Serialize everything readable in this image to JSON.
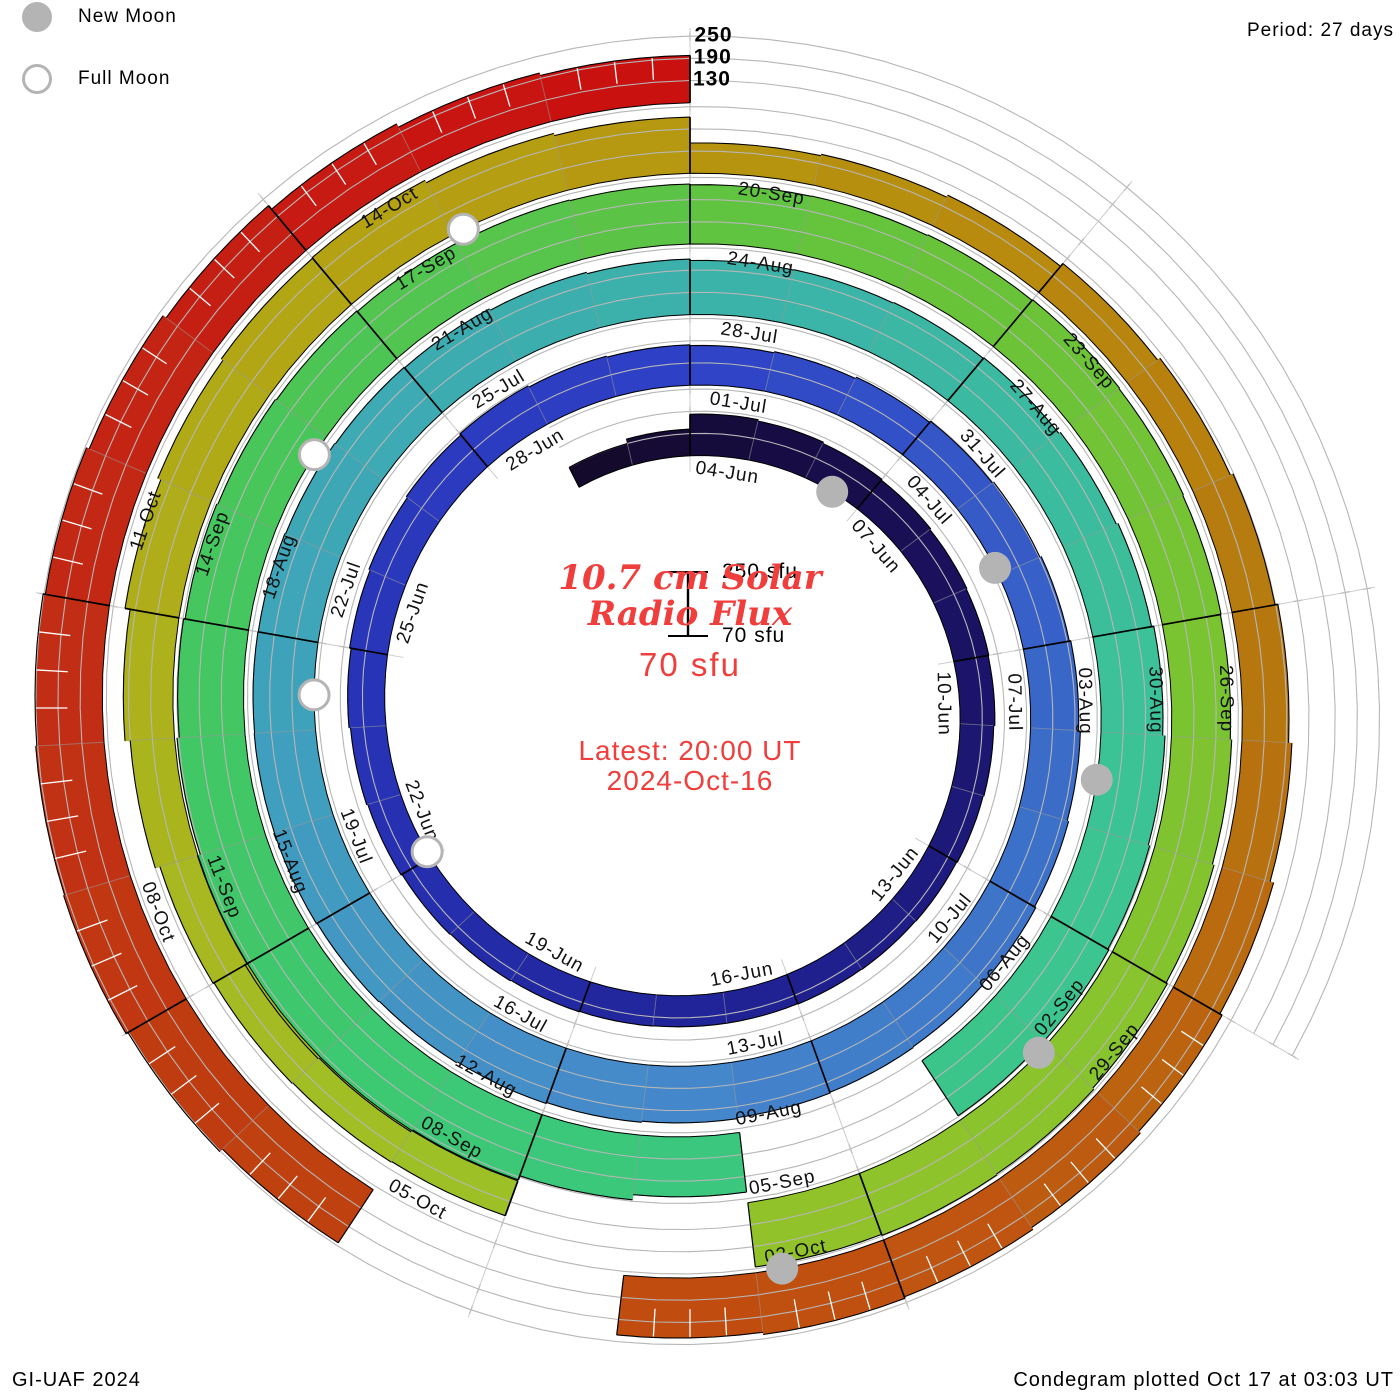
{
  "header": {
    "legend": {
      "new_moon": "New Moon",
      "full_moon": "Full Moon"
    },
    "period": "Period: 27 days"
  },
  "footer": {
    "left": "GI-UAF 2024",
    "right": "Condegram plotted Oct 17 at 03:03 UT"
  },
  "center": {
    "title_line1": "10.7 cm Solar",
    "title_line2": "Radio Flux",
    "base_flux": "70 sfu",
    "latest_line1": "Latest: 20:00 UT",
    "latest_line2": "2024-Oct-16",
    "scale_top_label": "250 sfu",
    "scale_bottom_label": "70 sfu"
  },
  "colors": {
    "accent_red": "#ef3e3c",
    "grid_gray": "#b6b6b6",
    "radial_gray": "#c4c4c4",
    "moon_gray": "#b4b4b4",
    "outline_black": "#000000",
    "label_black": "#111111"
  },
  "chart_data": {
    "type": "bar",
    "variant": "condegram-spiral",
    "title": "10.7 cm Solar Radio Flux",
    "start_date": "2024-06-02",
    "end_date": "2024-10-16",
    "period_days": 27,
    "flux_base_sfu": 70,
    "flux_scale_top_sfu": 250,
    "gridline_levels_sfu": [
      130,
      190,
      250
    ],
    "radial_scale_labels": [
      "250",
      "190",
      "130"
    ],
    "first_label_day_offset": 2,
    "label_step_days": 3,
    "date_labels": [
      "04-Jun",
      "07-Jun",
      "10-Jun",
      "13-Jun",
      "16-Jun",
      "19-Jun",
      "22-Jun",
      "25-Jun",
      "28-Jun",
      "01-Jul",
      "04-Jul",
      "07-Jul",
      "10-Jul",
      "13-Jul",
      "16-Jul",
      "19-Jul",
      "22-Jul",
      "25-Jul",
      "28-Jul",
      "31-Jul",
      "03-Aug",
      "06-Aug",
      "09-Aug",
      "12-Aug",
      "15-Aug",
      "18-Aug",
      "21-Aug",
      "24-Aug",
      "27-Aug",
      "30-Aug",
      "02-Sep",
      "05-Sep",
      "08-Sep",
      "11-Sep",
      "14-Sep",
      "17-Sep",
      "20-Sep",
      "23-Sep",
      "26-Sep",
      "29-Sep",
      "02-Oct",
      "05-Oct",
      "08-Oct",
      "11-Oct",
      "14-Oct"
    ],
    "flux": [
      130,
      142,
      182,
      178,
      174,
      171,
      168,
      166,
      164,
      161,
      159,
      157,
      156,
      155,
      154,
      154,
      155,
      156,
      158,
      160,
      163,
      166,
      170,
      174,
      178,
      182,
      186,
      182,
      179,
      177,
      180,
      184,
      188,
      192,
      196,
      200,
      205,
      209,
      213,
      216,
      218,
      220,
      223,
      226,
      229,
      232,
      234,
      236,
      236,
      235,
      234,
      232,
      230,
      228,
      224,
      220,
      216,
      217,
      219,
      221,
      226,
      231,
      237,
      243,
      247,
      250,
      248,
      null,
      null,
      232,
      246,
      258,
      265,
      268,
      262,
      254,
      248,
      244,
      241,
      238,
      236,
      234,
      232,
      230,
      231,
      233,
      235,
      233,
      231,
      229,
      233,
      238,
      242,
      246,
      248,
      245,
      null,
      null,
      170,
      172,
      174,
      177,
      190,
      204,
      218,
      227,
      233,
      235,
      228,
      222,
      152,
      156,
      162,
      172,
      180,
      188,
      196,
      205,
      215,
      222,
      228,
      234,
      238,
      232,
      null,
      null,
      242,
      252,
      258,
      255,
      252,
      246,
      238,
      228,
      215,
      205,
      198
    ],
    "color_stops": [
      [
        0,
        "#140928"
      ],
      [
        7,
        "#1a1160"
      ],
      [
        14,
        "#1f2190"
      ],
      [
        21,
        "#2731b4"
      ],
      [
        29,
        "#2e41c6"
      ],
      [
        36,
        "#3a6ac8"
      ],
      [
        43,
        "#4589cb"
      ],
      [
        50,
        "#3fa4ba"
      ],
      [
        57,
        "#3bb4a8"
      ],
      [
        64,
        "#3cc494"
      ],
      [
        71,
        "#3bc878"
      ],
      [
        78,
        "#46c65c"
      ],
      [
        85,
        "#67c33a"
      ],
      [
        92,
        "#85c42d"
      ],
      [
        99,
        "#9fc026"
      ],
      [
        104,
        "#aeb01b"
      ],
      [
        108,
        "#b5a011"
      ],
      [
        113,
        "#b8880e"
      ],
      [
        117,
        "#b7740f"
      ],
      [
        122,
        "#c05210"
      ],
      [
        127,
        "#bf3f10"
      ],
      [
        131,
        "#c22a16"
      ],
      [
        134,
        "#c51d12"
      ],
      [
        136,
        "#c91210"
      ]
    ],
    "moons": {
      "new": [
        {
          "date": "Jun-06",
          "t": 4.5
        },
        {
          "date": "Jul-05",
          "t": 33.9
        },
        {
          "date": "Aug-04",
          "t": 63.5
        },
        {
          "date": "Sep-03",
          "t": 93.1
        },
        {
          "date": "Oct-02",
          "t": 122.8
        }
      ],
      "full": [
        {
          "date": "Jun-22",
          "t": 20.1
        },
        {
          "date": "Jul-21",
          "t": 49.4
        },
        {
          "date": "Aug-19",
          "t": 78.8
        },
        {
          "date": "Sep-18",
          "t": 108.1
        }
      ]
    }
  }
}
